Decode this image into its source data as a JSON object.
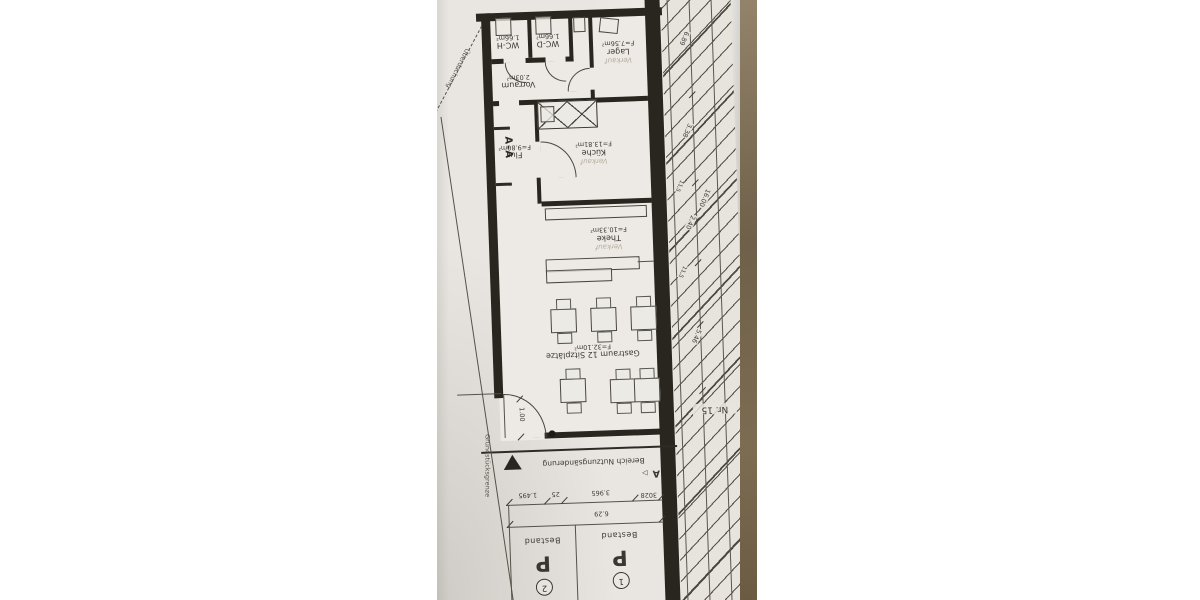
{
  "plan": {
    "rooms": [
      {
        "name": "WC-H",
        "area": "1.66m²"
      },
      {
        "name": "WC-D",
        "area": "1.66m²"
      },
      {
        "name": "Vorraum",
        "area": "2.03m²"
      },
      {
        "name": "Lager",
        "area": "F=7.56m²",
        "note": "Verkauf"
      },
      {
        "name": "Flur",
        "area": "F=9.80m²"
      },
      {
        "name": "Küche",
        "area": "F=13.81m²",
        "note": "Verkauf"
      },
      {
        "name": "Theke",
        "area": "F=10.33m²",
        "note": "Verkauf"
      },
      {
        "name": "Gastraum 12 Sitzplätze",
        "area": "F=32.10m²"
      }
    ],
    "annotations": {
      "section_marker": "A-A",
      "section_letter": "A",
      "section_arrow": "▷",
      "usage_boundary": "Bereich Nutzungsänderung",
      "property_line": "Grundstücksgrenze",
      "canopy": "Überdachung",
      "neighbor_no": "Nr. 15",
      "door_width": "1.00"
    },
    "dims_bottom": [
      "1.495",
      "25",
      "3.965",
      "3028",
      "6.29"
    ],
    "dims_right": [
      "6.89",
      "3.38",
      "11,5",
      "16.00",
      "2.40",
      "11,5",
      "5.46"
    ],
    "parking": {
      "stalls": [
        {
          "label": "P",
          "status": "Bestand",
          "number": "1"
        },
        {
          "label": "P",
          "status": "Bestand",
          "number": "2"
        }
      ]
    },
    "colors": {
      "paper": "#e9e6e1",
      "ink": "#3a3733",
      "wall": "#29261f",
      "desk": "#7d6c50"
    }
  }
}
